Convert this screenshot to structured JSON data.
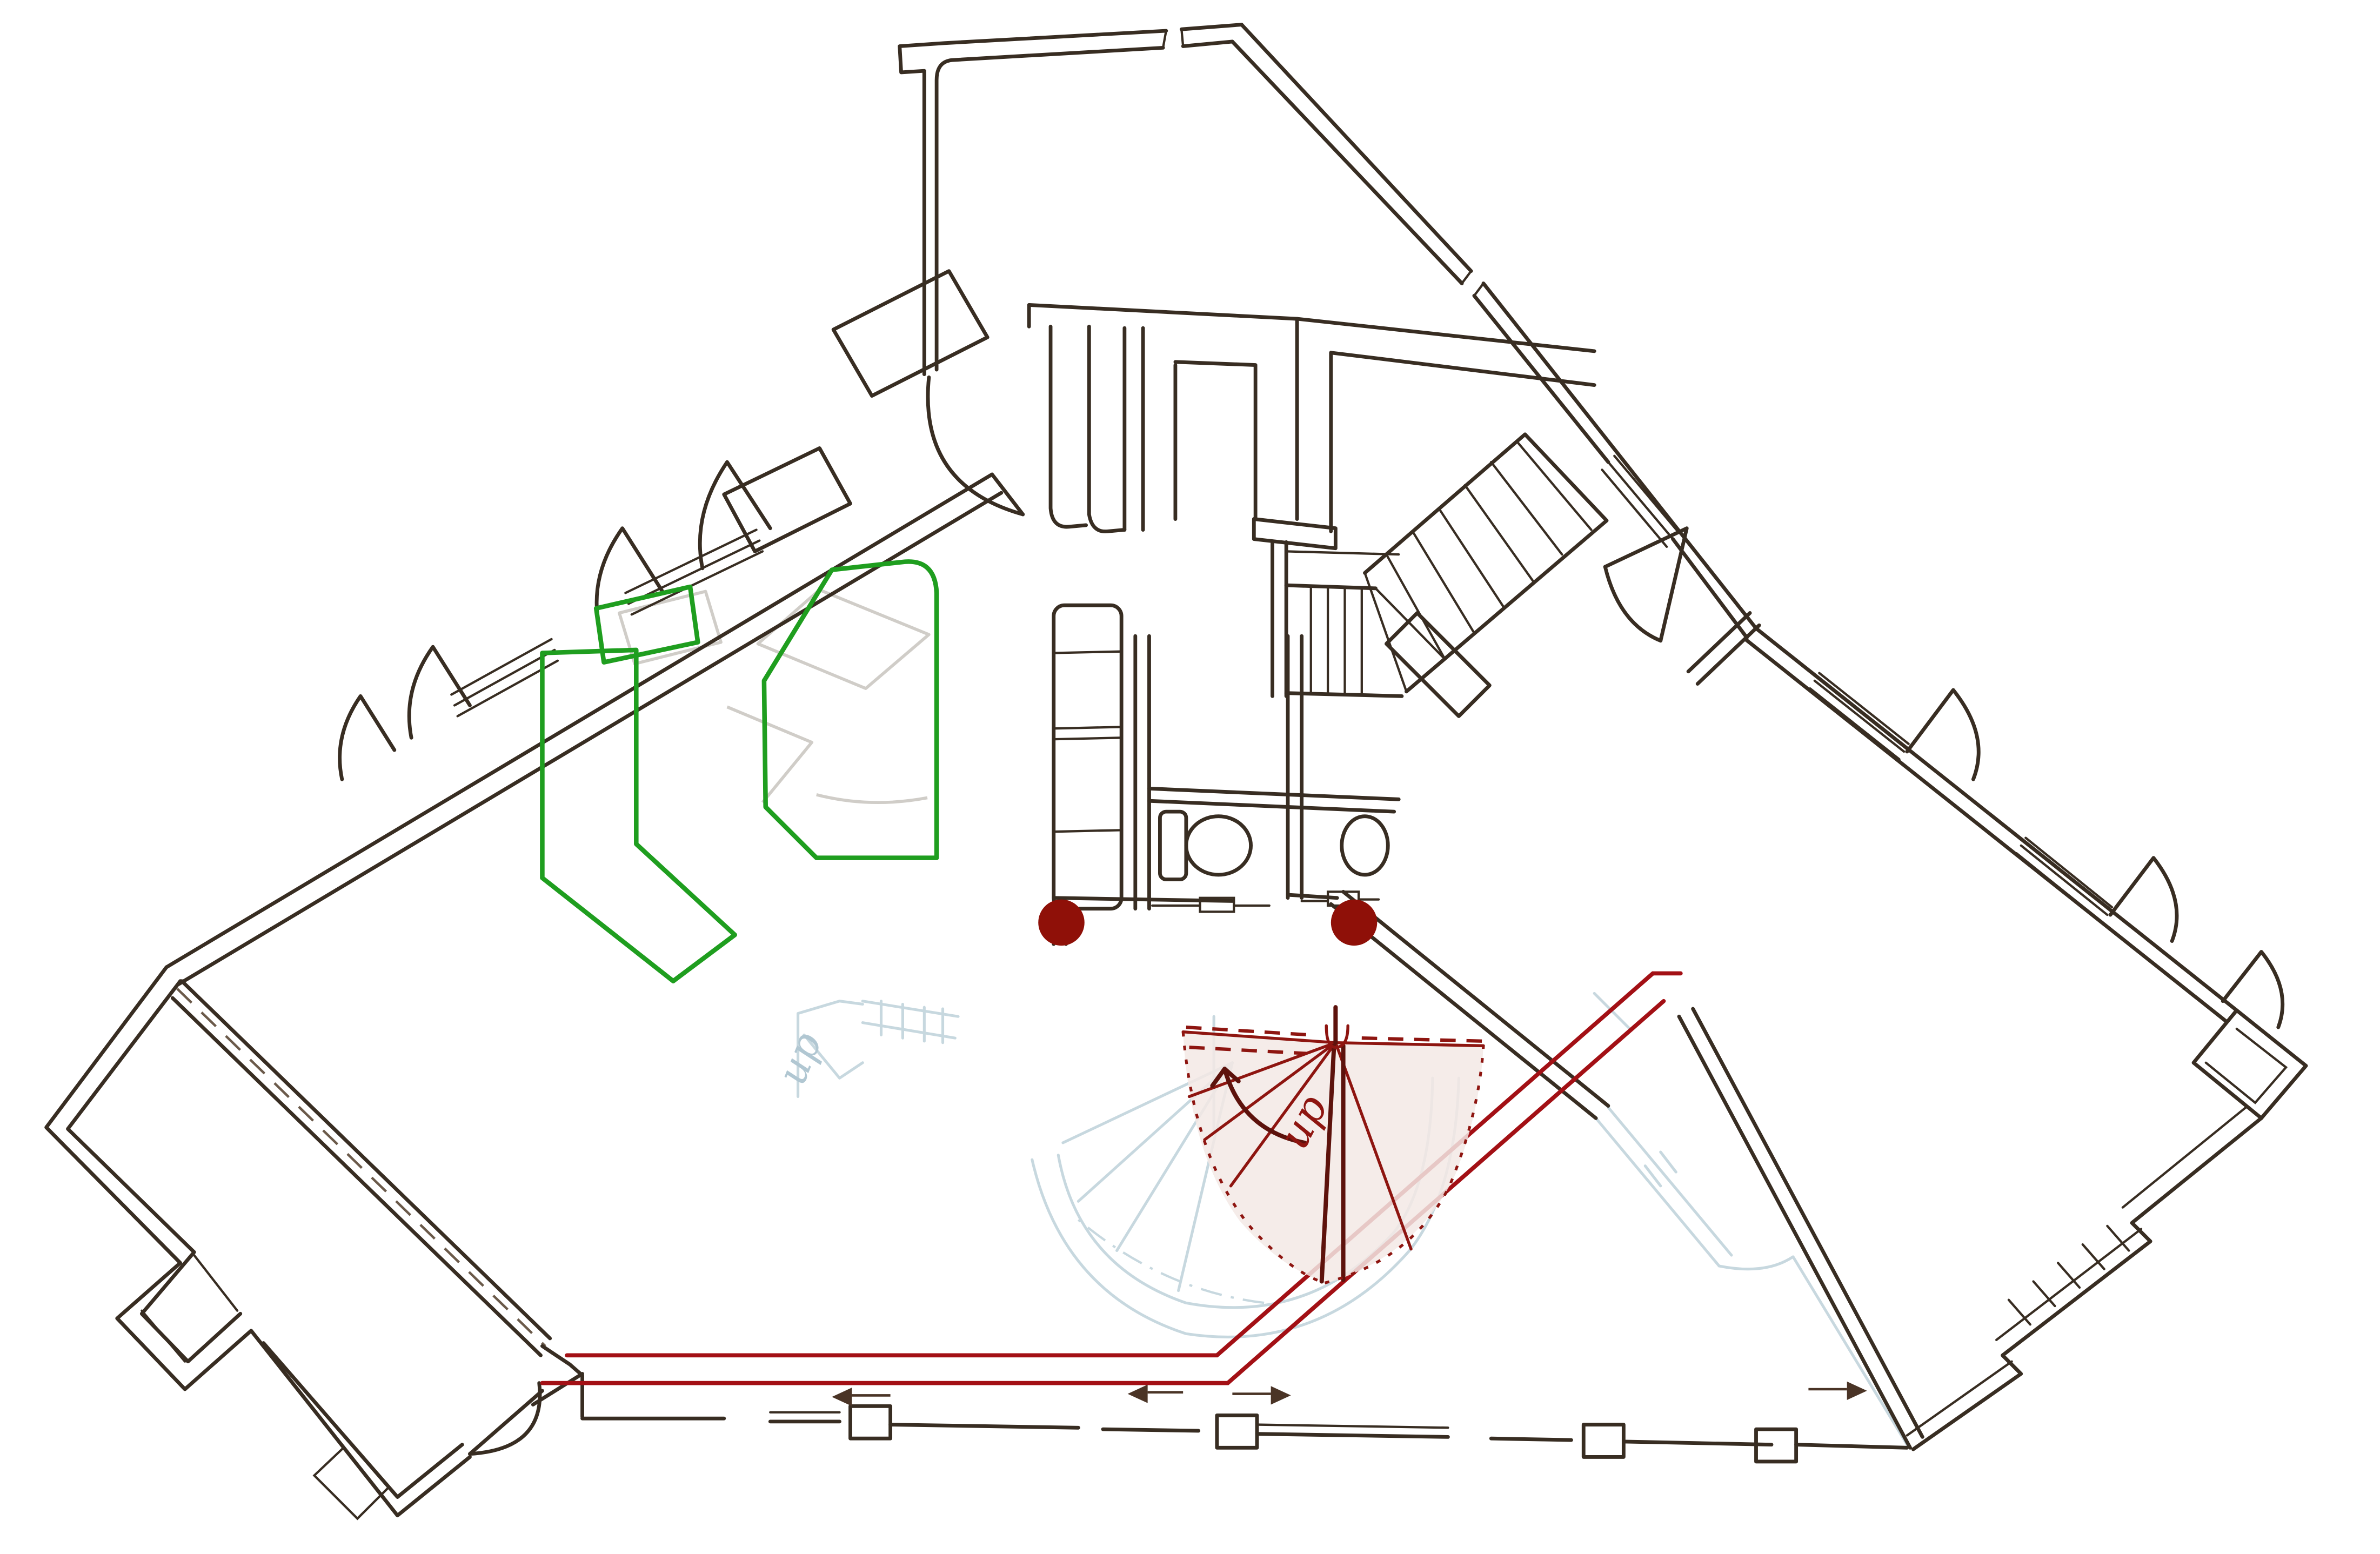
{
  "document": {
    "kind": "hand-drawn floor plan sketch (scanned)",
    "visible_text_items": 2
  },
  "annotations": {
    "up_red": {
      "label": "up"
    },
    "up_ghost": {
      "label": "up"
    }
  },
  "markers": {
    "column_dots": {
      "count": 2
    },
    "direction_arrows": {
      "count": 4
    }
  },
  "legend": {
    "ink_layer": "current floor walls, stairs, toilet, sink, closets, doors, windows",
    "green_layer": "furniture / zone outlines (3 shapes)",
    "red_layer": "circulation path lines",
    "dark_red_layer": "winder stair fan with up arrow",
    "ghost_layers": "faded lower-floor drawing (blue) and erased furniture (gray)"
  },
  "colors": {
    "ink": "#382d22",
    "green": "#1f9e1f",
    "red_line": "#a31015",
    "dark_red": "#8e1510",
    "dot_red": "#8f1008",
    "fan_tint": "#f3e9e5",
    "ghost_blue": "#c2d4dc",
    "ghost_blue_text": "#a9c2ce",
    "ghost_gray": "#d0cdc8",
    "arrow_brown": "#4a3426",
    "paper": "#ffffff"
  }
}
